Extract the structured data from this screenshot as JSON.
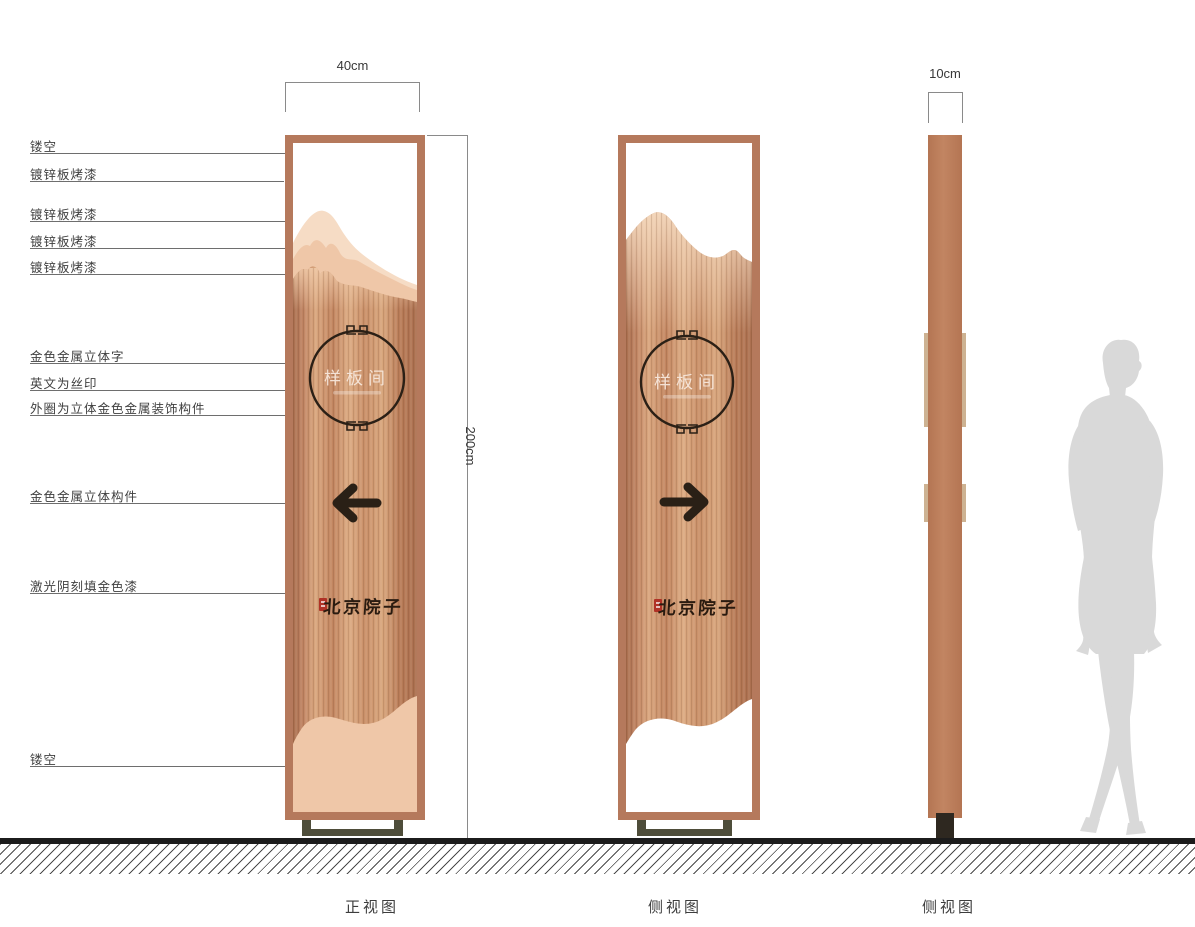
{
  "views": [
    {
      "label": "正视图"
    },
    {
      "label": "侧视图"
    },
    {
      "label": "侧视图"
    }
  ],
  "dimensions": {
    "front_width": "40cm",
    "total_height": "200cm",
    "side_depth": "10cm"
  },
  "callouts": [
    {
      "label": "镂空"
    },
    {
      "label": "镀锌板烤漆"
    },
    {
      "label": "镀锌板烤漆"
    },
    {
      "label": "镀锌板烤漆"
    },
    {
      "label": "镀锌板烤漆"
    },
    {
      "label": "金色金属立体字"
    },
    {
      "label": "英文为丝印"
    },
    {
      "label": "外圈为立体金色金属装饰构件"
    },
    {
      "label": "金色金属立体构件"
    },
    {
      "label": "激光阴刻填金色漆"
    },
    {
      "label": "镂空"
    }
  ],
  "sign_content": {
    "room_name": "样板间",
    "brand_name": "北京院子",
    "front_arrow_direction": "left",
    "second_view_arrow_direction": "right"
  },
  "colors": {
    "frame": "#b5795c",
    "copper_dark": "#a86e4e",
    "copper_light": "#dcab83",
    "mountain_back": "#f6dcc5",
    "mountain_mid": "#efc7a8",
    "ornament_dark": "#2b2016",
    "base": "#4e4d3a",
    "ground": "#1c1c1c",
    "silhouette": "#d9d9d9",
    "seal_red": "#b03226"
  }
}
